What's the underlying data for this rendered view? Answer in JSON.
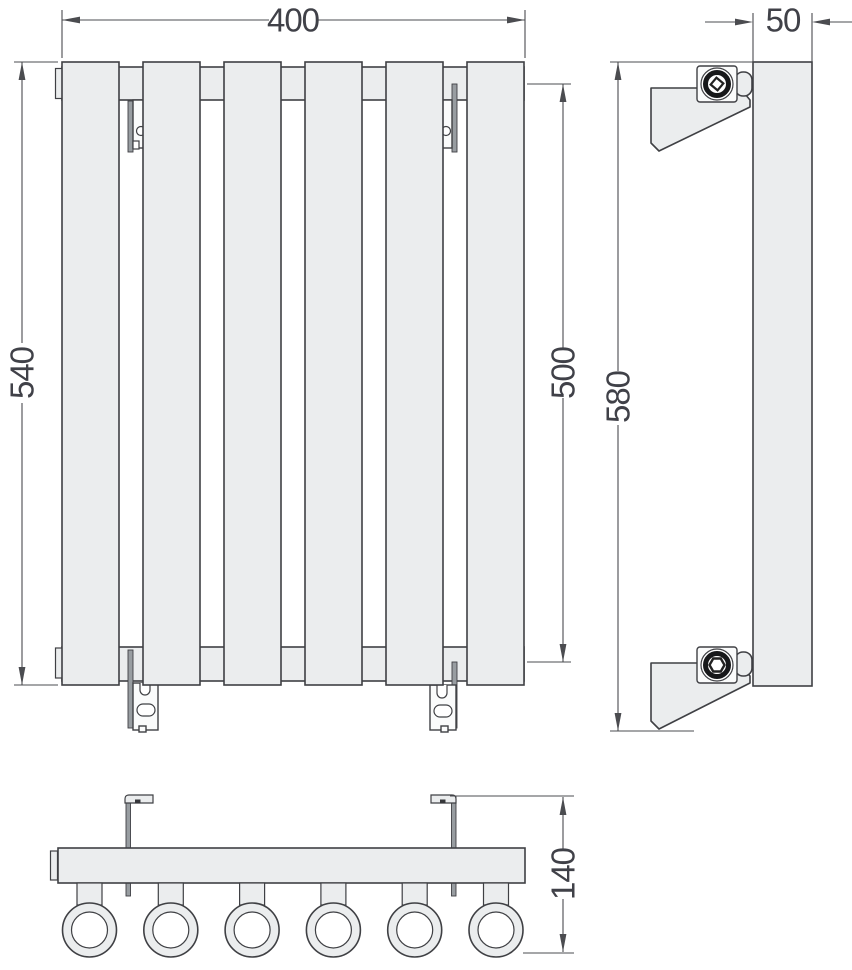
{
  "drawing": {
    "dimensions": {
      "width": "400",
      "overall_height": "540",
      "collector_span": "500",
      "depth": "50",
      "bracket_span": "580",
      "bottom_depth": "140"
    },
    "front_view": {
      "panel_count": 6
    },
    "bottom_view": {
      "tube_count": 6,
      "tube_pitch_px": 81.3,
      "first_tube_x": 89.5
    },
    "colors": {
      "fill": "#ebedee",
      "line": "#3f4044",
      "dimension": "#4b4c50",
      "rail": "#989da1",
      "background": "#ffffff"
    }
  }
}
